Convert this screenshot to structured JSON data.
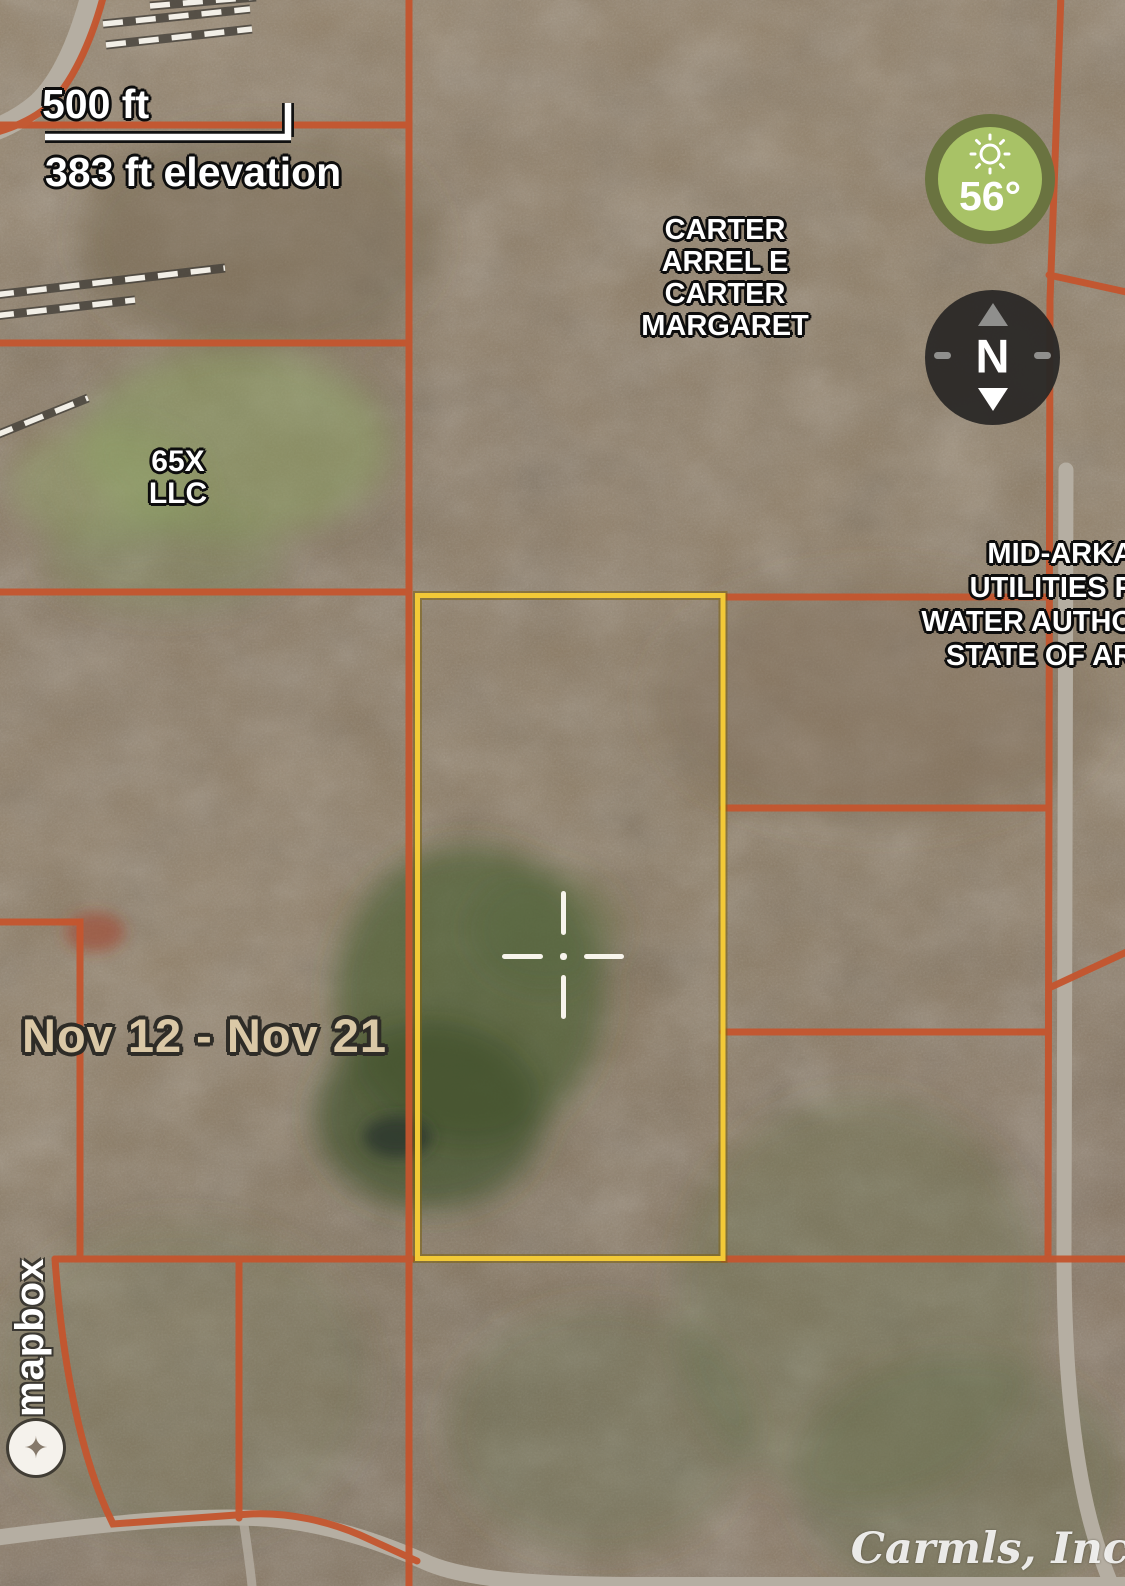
{
  "overlay": {
    "scale_label": "500 ft",
    "elevation_label": "383 ft elevation",
    "date_range": "Nov 12 - Nov 21",
    "temperature": "56°",
    "compass_north": "N",
    "watermark": "Carmls, Inc",
    "logo_text": "mapbox",
    "logo_star": "✦"
  },
  "parcels": {
    "carter": [
      "CARTER",
      "ARREL E",
      "CARTER",
      "MARGARET"
    ],
    "llc": [
      "65X",
      "LLC"
    ],
    "utility": [
      "MID-ARKA",
      "UTILITIES P",
      "WATER AUTHO",
      "STATE OF AR"
    ]
  },
  "colors": {
    "parcel_line": "#c4552e",
    "selected_parcel": "#f2c937",
    "weather_ring": "#6a7340",
    "weather_fill": "#a8c266",
    "date_text": "#dac8a6"
  }
}
